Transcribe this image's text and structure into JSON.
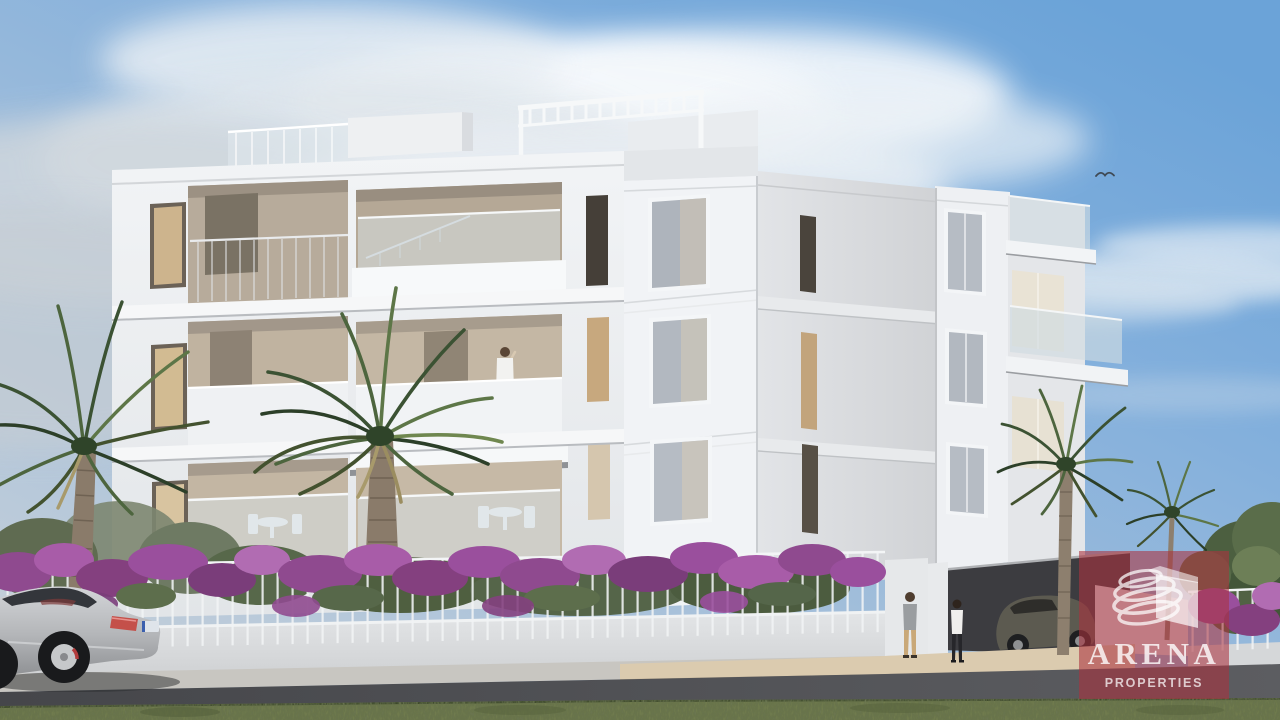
{
  "image": {
    "alt": "3D architectural rendering of a modern white apartment building with recessed balconies, glass railings, rooftop pergola, palm trees, purple bougainvillea hedge over a white fence, a silver sports coupe parked on the street, two pedestrians near the entrance, a person on a balcony, blue sky with clouds"
  },
  "watermark": {
    "brand": "ARENA",
    "tagline": "PROPERTIES",
    "overlay_color": "#aa323e",
    "overlay_opacity": "0.58",
    "text_color": "#ffffff"
  },
  "palette": {
    "sky_top_right": "#6ba3d8",
    "sky_left": "#ccd3d9",
    "cloud": "#e8ecef",
    "building_white": "#f0f2f5",
    "building_shadow_face": "#d8dadd",
    "recess_warm": "#bfb2a0",
    "window_warm_glass": "#cdb48d",
    "window_cool_glass": "#b6bcc4",
    "bougainvillea_purple": "#9a4f9d",
    "foliage_green": "#4d653e",
    "grass_green": "#6d7852",
    "road_asphalt": "#4b4c4f",
    "boundary_wall": "#d9dbdd",
    "walkway_beige": "#dbcbaf",
    "car_silver": "#c0c2c5",
    "tail_light_red": "#c4504a"
  }
}
